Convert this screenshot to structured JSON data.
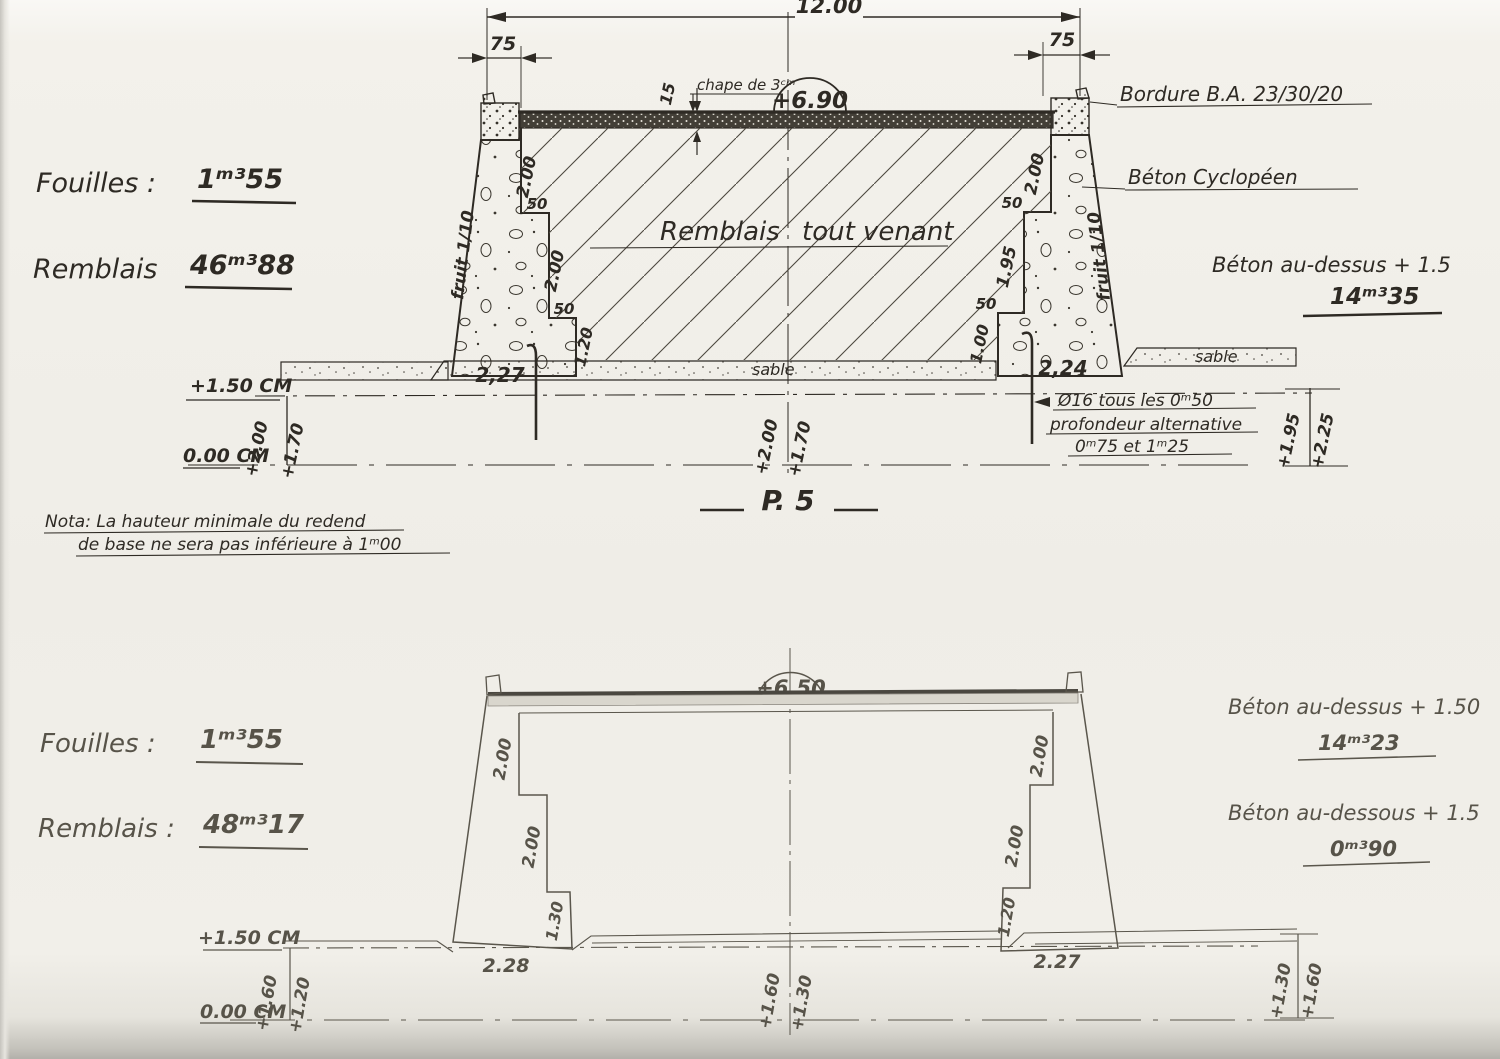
{
  "title": "P. 5",
  "top": {
    "overall_width": "12.00",
    "curb_left": "75",
    "curb_right": "75",
    "crown_level": "+6.90",
    "chape_note": "chape de 3ᶜᵐ",
    "chape_thickness": "15",
    "fouilles_label": "Fouilles :",
    "fouilles_value": "1ᵐ³55",
    "remblais_label": "Remblais",
    "remblais_value": "46ᵐ³88",
    "bordure_note": "Bordure B.A. 23/30/20",
    "beton_cyclopeen_note": "Béton Cyclopéen",
    "beton_dessus_note": "Béton au-dessus + 1.5",
    "beton_dessus_value": "14ᵐ³35",
    "fruit_left": "fruit 1/10",
    "fruit_right": "fruit 1/10",
    "fill_word1": "Remblais",
    "fill_word2": "tout venant",
    "sable_center": "sable",
    "sable_right": "sable",
    "left_wall": {
      "d1": "2.00",
      "d2": "50",
      "d3": "2.00",
      "d4": "50",
      "d5": "1.20",
      "base": "2,27"
    },
    "right_wall": {
      "d1": "2.00",
      "d2": "50",
      "d3": "1.95",
      "d4": "50",
      "d5": "1.00",
      "base": "2,24"
    },
    "levels": {
      "l150": "+1.50 CM",
      "l000": "0.00 CM",
      "left_v1": "+2.00",
      "left_v2": "+1.70",
      "center_v1": "+2.00",
      "center_v2": "+1.70",
      "right_v1": "+1.95",
      "right_v2": "+2.25"
    },
    "rebar_note1": "Ø16 tous les 0ᵐ50",
    "rebar_note2": "profondeur alternative",
    "rebar_note3": "0ᵐ75  et  1ᵐ25"
  },
  "nota": {
    "line1": "Nota: La hauteur minimale du redend",
    "line2": "de base ne sera pas inférieure à 1ᵐ00"
  },
  "bottom": {
    "crown_level": "+6.50",
    "fouilles_label": "Fouilles :",
    "fouilles_value": "1ᵐ³55",
    "remblais_label": "Remblais :",
    "remblais_value": "48ᵐ³17",
    "beton_dessus_note": "Béton au-dessus + 1.50",
    "beton_dessus_value": "14ᵐ³23",
    "beton_dessous_note": "Béton au-dessous + 1.5",
    "beton_dessous_value": "0ᵐ³90",
    "left_wall": {
      "d1": "2.00",
      "d2": "2.00",
      "d3": "1.30",
      "base": "2.28"
    },
    "right_wall": {
      "d1": "2.00",
      "d2": "2.00",
      "d3": "1.20",
      "base": "2.27"
    },
    "levels": {
      "l150": "+1.50 CM",
      "l000": "0.00 CM",
      "left_v1": "+1.60",
      "left_v2": "+1.20",
      "center_v1": "+1.60",
      "center_v2": "+1.30",
      "right_v1": "+1.30",
      "right_v2": "+1.60"
    }
  }
}
